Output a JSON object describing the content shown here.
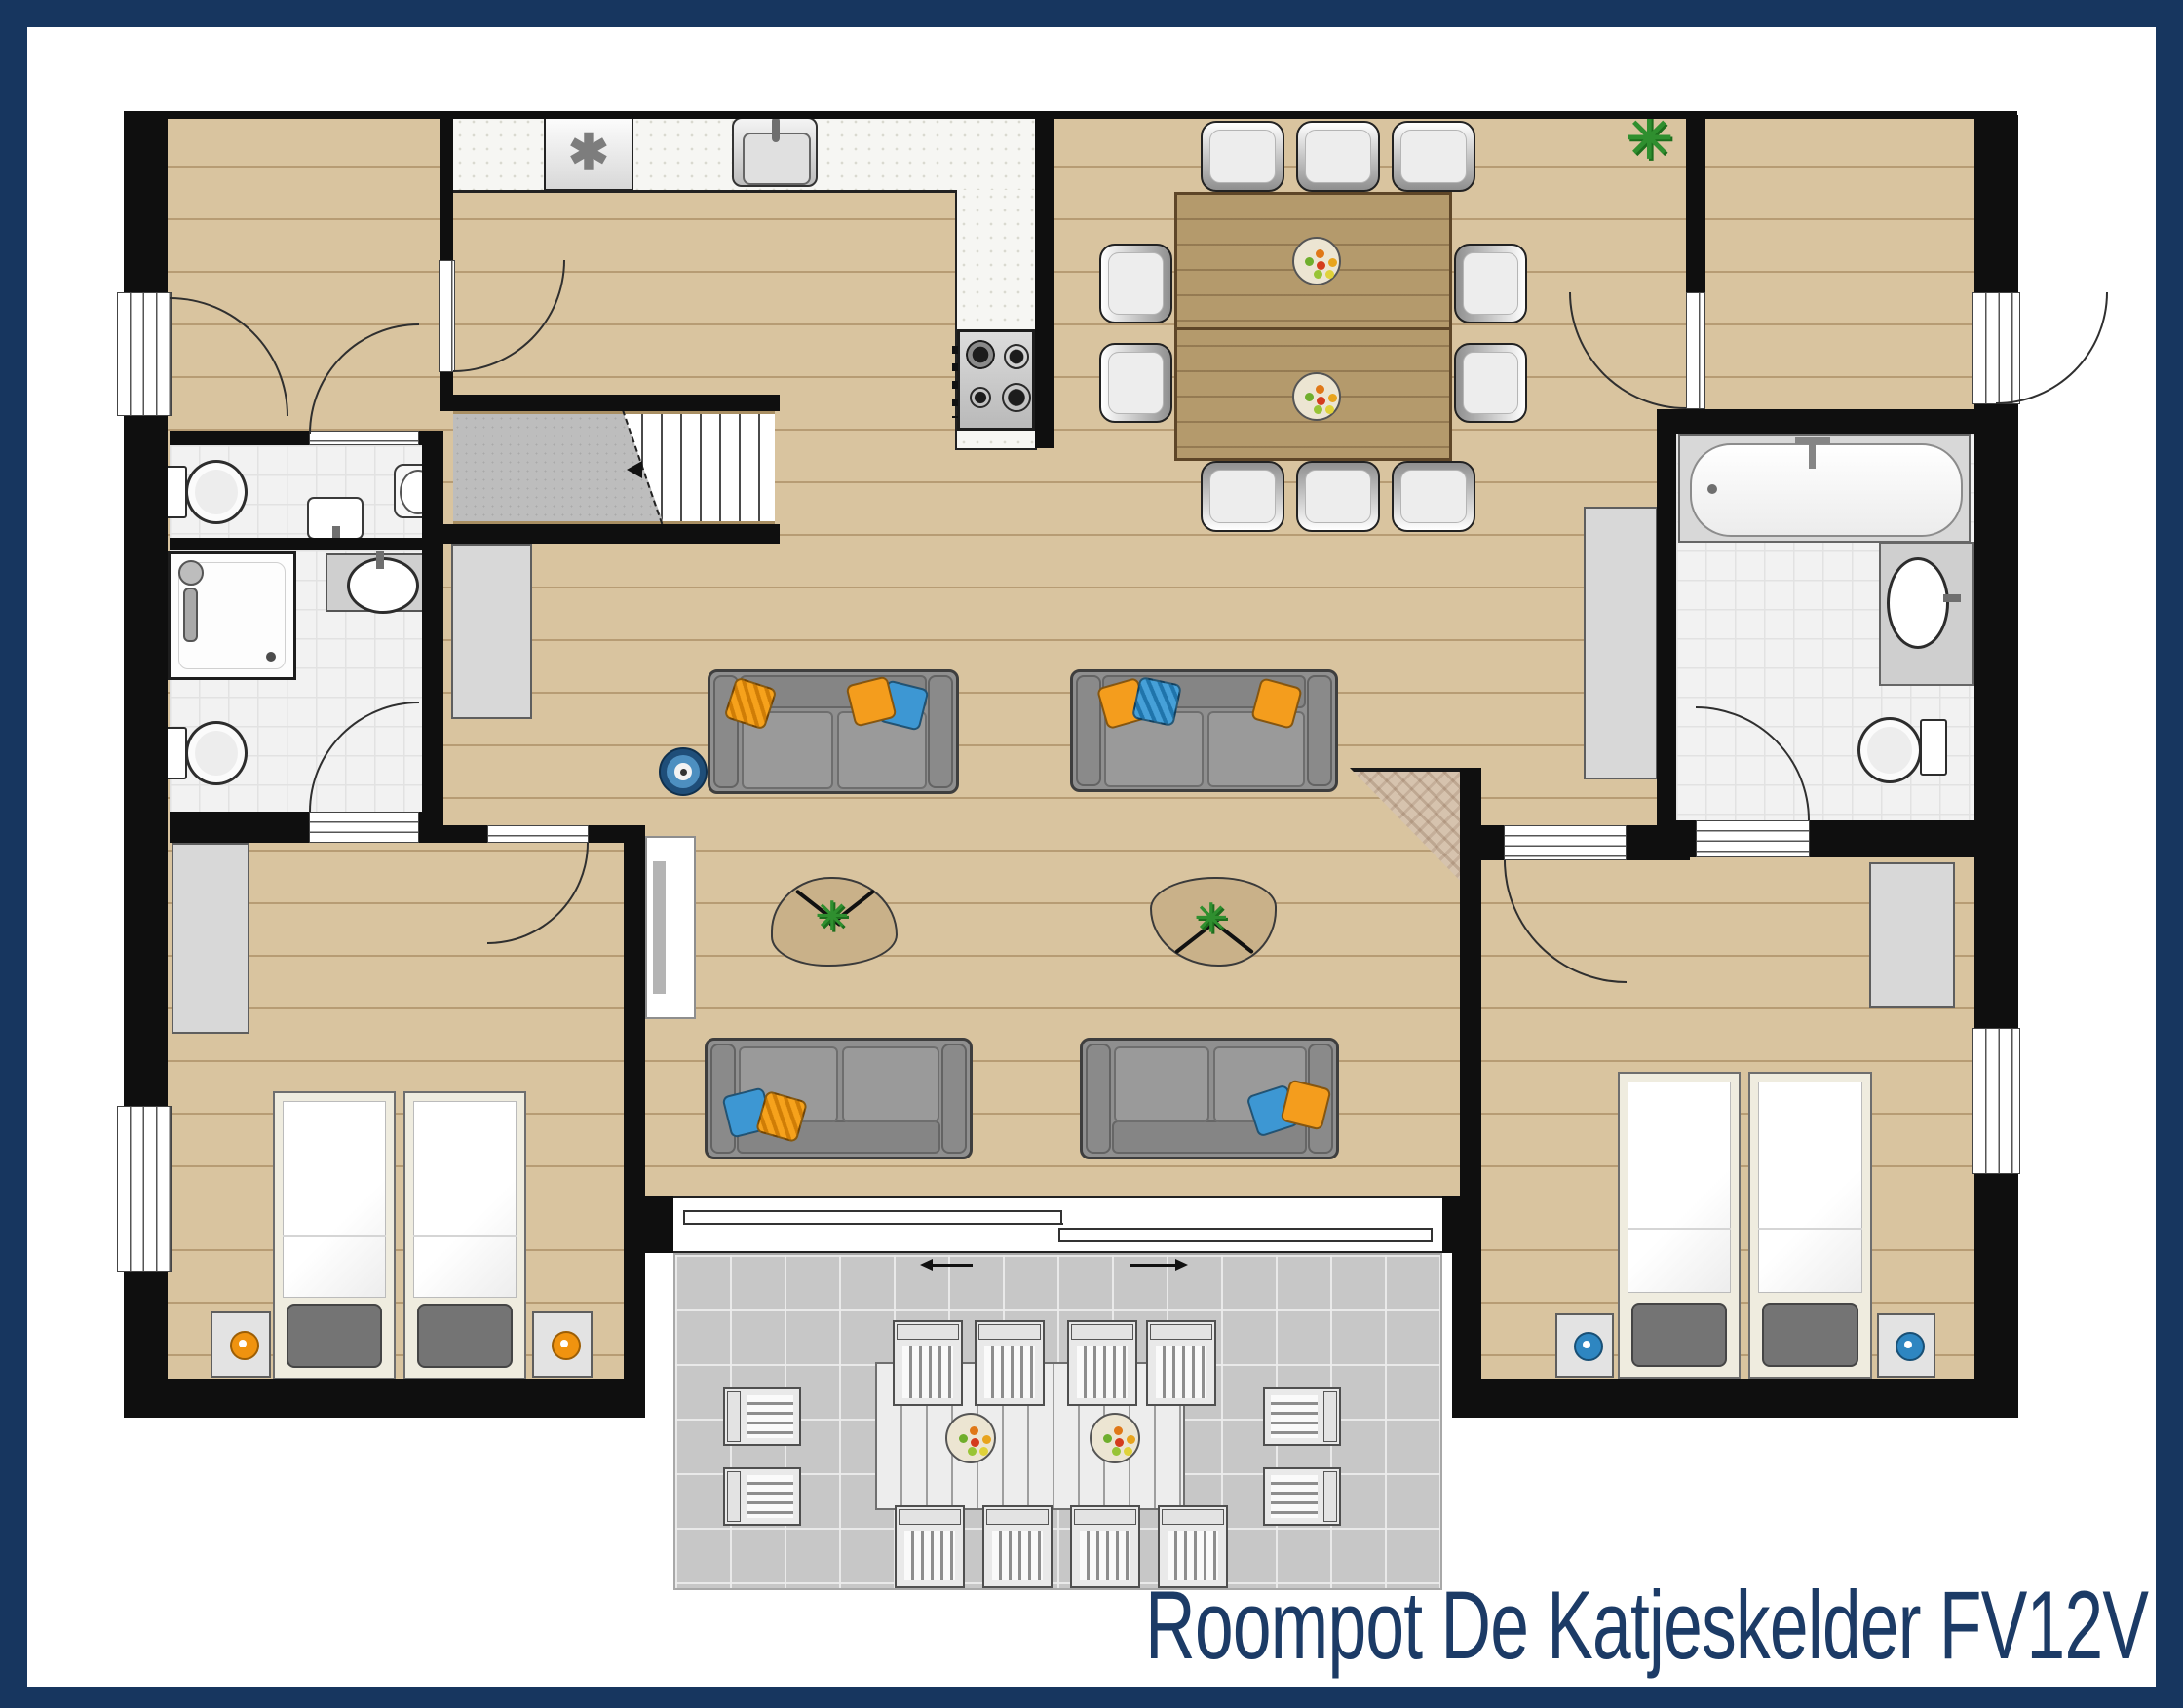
{
  "title": {
    "text": "Roompot De Katjeskelder FV12V"
  },
  "icons": {
    "freezer_symbol": "✱"
  },
  "palette": {
    "border_navy": "#17365f",
    "title_navy": "#1c3b66",
    "wall_black": "#0f0f0f",
    "wood_floor": "#d9c49f",
    "bath_tile": "#f2f2f2",
    "kitchen_floor": "#f6f6f3",
    "terrace_gray": "#c7c7c7",
    "cabinet_gray": "#d8d8d8",
    "sofa_gray": "#8f8f8f",
    "pillow_orange": "#f49d1d",
    "pillow_blue": "#3d97d3",
    "dining_table_wood": "#b49a6c",
    "coffee_table_tan": "#c9b189",
    "plant_green": "#2f8f2f",
    "lamp_knob_orange": "#f0930f",
    "lamp_knob_blue": "#2e86c1"
  },
  "plan": {
    "rooms": [
      {
        "name": "entrance-hall-left",
        "fixtures": [
          "entry-door",
          "doors"
        ]
      },
      {
        "name": "wc",
        "fixtures": [
          "toilet",
          "hand-basin",
          "wall-basin"
        ]
      },
      {
        "name": "bathroom-left",
        "fixtures": [
          "shower",
          "washbasin",
          "toilet",
          "door"
        ]
      },
      {
        "name": "kitchen",
        "fixtures": [
          "counter",
          "freezer",
          "sink",
          "stove-4-burner"
        ]
      },
      {
        "name": "staircase",
        "fixtures": [
          "landing",
          "steps",
          "direction-arrow"
        ]
      },
      {
        "name": "dining-area",
        "fixtures": [
          "dining-table",
          "10-chairs",
          "2-fruit-bowls",
          "plant",
          "cabinet"
        ]
      },
      {
        "name": "living-area",
        "fixtures": [
          "4-sofas",
          "2-coffee-tables",
          "robot-vacuum",
          "tv-unit",
          "corner-fireplace",
          "sliding-door"
        ]
      },
      {
        "name": "entrance-hall-right",
        "fixtures": [
          "entry-door",
          "door"
        ]
      },
      {
        "name": "bathroom-right",
        "fixtures": [
          "bathtub",
          "washbasin",
          "toilet",
          "door"
        ]
      },
      {
        "name": "bedroom-left",
        "fixtures": [
          "2-single-beds",
          "2-nightstands-orange-lamps",
          "wardrobe",
          "window"
        ]
      },
      {
        "name": "bedroom-right",
        "fixtures": [
          "2-single-beds",
          "2-nightstands-blue-lamps",
          "wardrobe",
          "window"
        ]
      },
      {
        "name": "terrace",
        "fixtures": [
          "outdoor-table",
          "12-outdoor-chairs",
          "2-fruit-bowls"
        ]
      }
    ],
    "counts": {
      "sofas": 4,
      "dining_chairs": 10,
      "terrace_chairs": 12,
      "beds": 4,
      "toilets": 3,
      "bathrooms": 2
    }
  }
}
